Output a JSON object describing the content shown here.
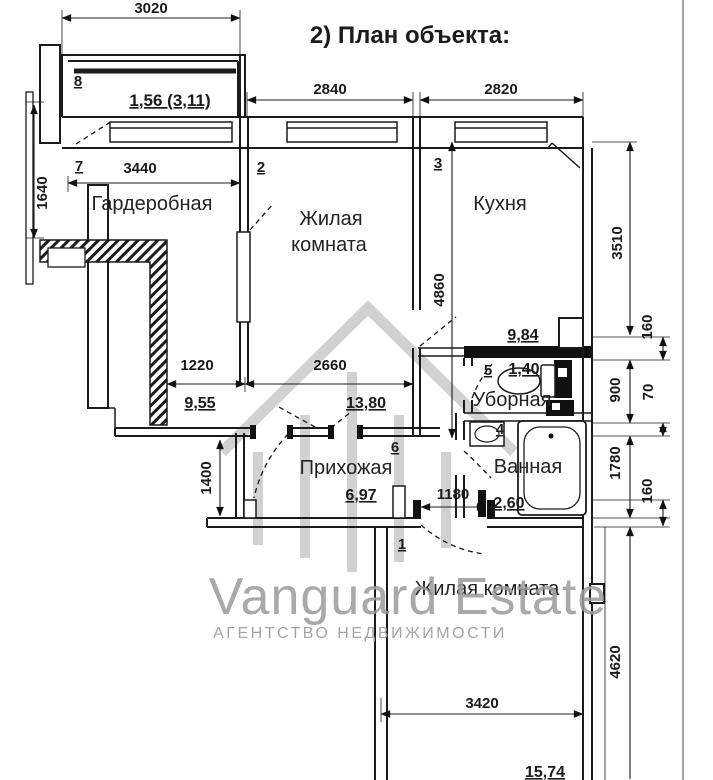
{
  "title": "2) План объекта:",
  "plan": {
    "rooms": [
      {
        "number": "1",
        "name": "Жилая комната",
        "area": "15,74"
      },
      {
        "number": "2",
        "name": "Жилая комната",
        "name_lines": [
          "Жилая",
          "комната"
        ],
        "area": "13,80"
      },
      {
        "number": "3",
        "name": "Кухня",
        "area": "9,84"
      },
      {
        "number": "4",
        "name": "Ванная",
        "area": "2,60"
      },
      {
        "number": "5",
        "name": "Уборная",
        "area": "1,40"
      },
      {
        "number": "6",
        "name": "Прихожая",
        "area": "6,97"
      },
      {
        "number": "7",
        "name": "Гардеробная",
        "area": "9,55"
      },
      {
        "number": "8",
        "name": "",
        "area": "1,56 (3,11)"
      }
    ],
    "dimensions": {
      "top": [
        "3020",
        "2840",
        "2820"
      ],
      "left": [
        "1640"
      ],
      "inner_h": [
        "3440",
        "1220",
        "2660",
        "1180",
        "3420"
      ],
      "inner_v": [
        "4860",
        "1400"
      ],
      "right": [
        "3510",
        "160",
        "900",
        "70",
        "1780",
        "160",
        "4620"
      ]
    },
    "colors": {
      "line": "#1b1b1b",
      "background": "#ffffff"
    }
  },
  "watermark": {
    "brand": "Vanguard Estate",
    "tagline": "АГЕНТСТВО НЕДВИЖИМОСТИ",
    "icon": "house-watermark-icon",
    "color": "#a6a6a6"
  }
}
